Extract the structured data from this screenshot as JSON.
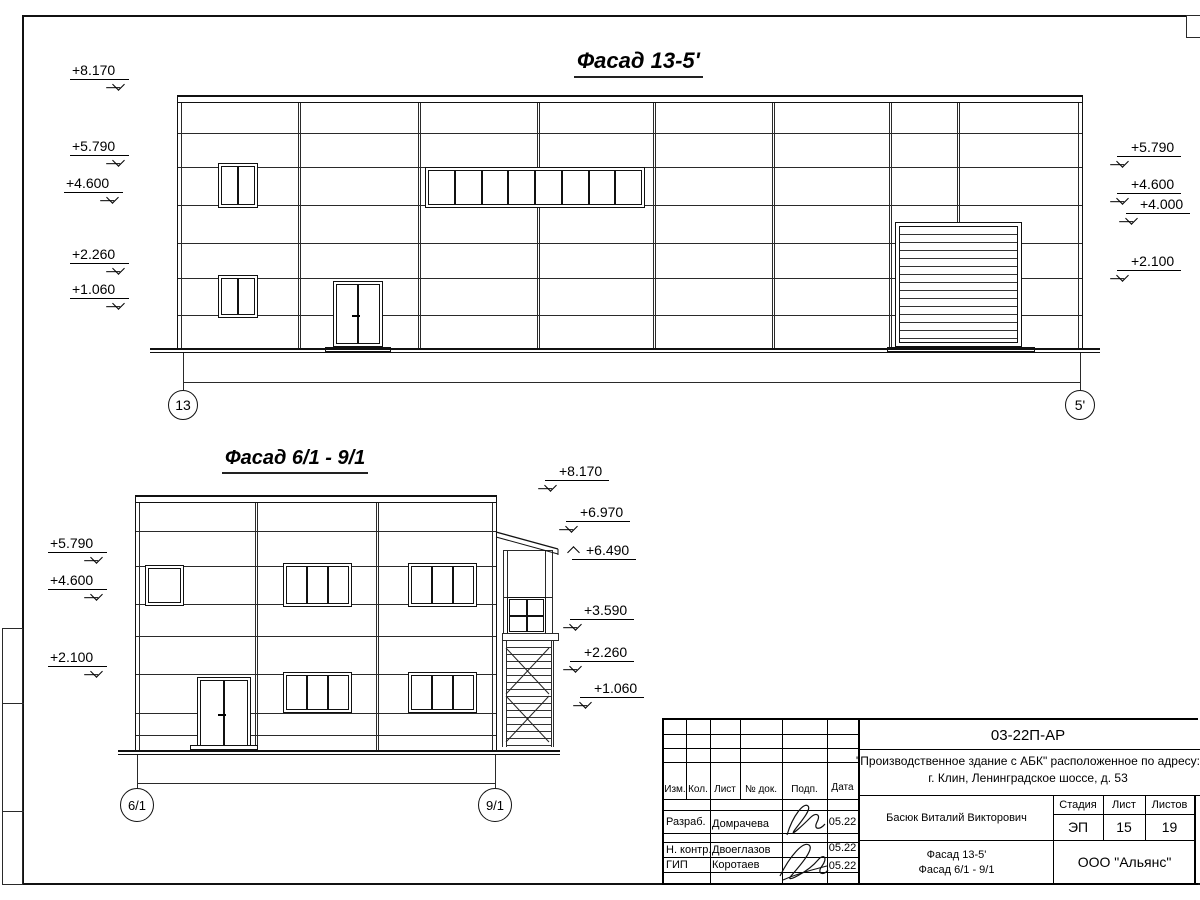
{
  "sheet": {
    "facade1": {
      "title": "Фасад 13-5'",
      "axis_left": "13",
      "axis_right": "5'",
      "levels_left": [
        "+8.170",
        "+5.790",
        "+4.600",
        "+2.260",
        "+1.060"
      ],
      "levels_right": [
        "+5.790",
        "+4.600",
        "+4.000",
        "+2.100"
      ]
    },
    "facade2": {
      "title": "Фасад 6/1 - 9/1",
      "axis_left": "6/1",
      "axis_right": "9/1",
      "levels_left": [
        "+5.790",
        "+4.600",
        "+2.100"
      ],
      "levels_right": [
        "+8.170",
        "+6.970",
        "+6.490",
        "+3.590",
        "+2.260",
        "+1.060"
      ]
    },
    "titleblock": {
      "doc_number": "03-22П-АР",
      "project_line1": "\"Производственное здание с АБК\" расположенное по адресу:",
      "project_line2": "г. Клин, Ленинградское шоссе, д. 53",
      "rev_columns": [
        "Изм.",
        "Кол.",
        "Лист",
        "№ док.",
        "Подп.",
        "Дата"
      ],
      "signers": [
        {
          "role": "Разраб.",
          "name": "Домрачева",
          "date": "05.22"
        },
        {
          "role": "Н. контр.",
          "name": "Двоеглазов",
          "date": "05.22"
        },
        {
          "role": "ГИП",
          "name": "Коротаев",
          "date": "05.22"
        }
      ],
      "approver": "Басюк Виталий Викторович",
      "stage_label": "Стадия",
      "sheet_label": "Лист",
      "sheets_label": "Листов",
      "stage": "ЭП",
      "sheet_no": "15",
      "sheets_total": "19",
      "drawing_title_line1": "Фасад 13-5'",
      "drawing_title_line2": "Фасад 6/1 - 9/1",
      "company": "ООО \"Альянс\""
    }
  }
}
